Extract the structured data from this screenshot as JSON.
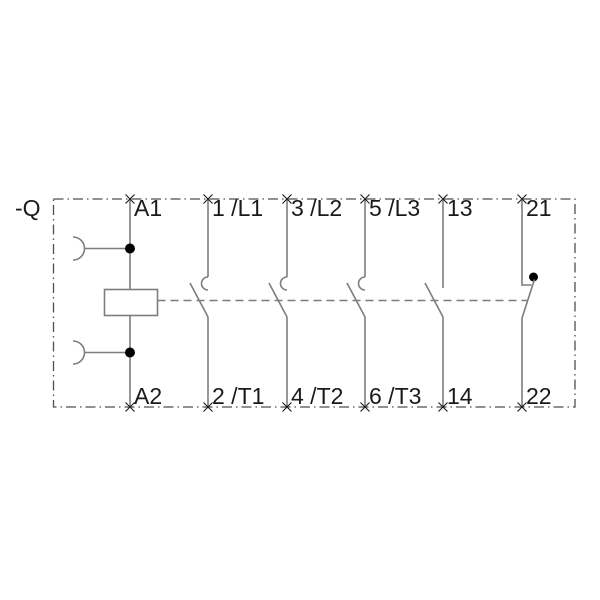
{
  "colors": {
    "background": "#ffffff",
    "wire": "#7d7d7d",
    "border": "#4f4f4f",
    "text": "#1a1a1a",
    "contact-dot": "#000000"
  },
  "schematic": {
    "device_label": "-Q",
    "coil": {
      "top_terminal": "A1",
      "bottom_terminal": "A2",
      "symbol": "contactor-coil"
    },
    "poles": [
      {
        "top_terminal": "1 /L1",
        "bottom_terminal": "2 /T1",
        "symbol": "main-no-contact"
      },
      {
        "top_terminal": "3 /L2",
        "bottom_terminal": "4 /T2",
        "symbol": "main-no-contact"
      },
      {
        "top_terminal": "5 /L3",
        "bottom_terminal": "6 /T3",
        "symbol": "main-no-contact"
      },
      {
        "top_terminal": "13",
        "bottom_terminal": "14",
        "symbol": "aux-no-contact"
      },
      {
        "top_terminal": "21",
        "bottom_terminal": "22",
        "symbol": "aux-nc-contact"
      }
    ]
  }
}
